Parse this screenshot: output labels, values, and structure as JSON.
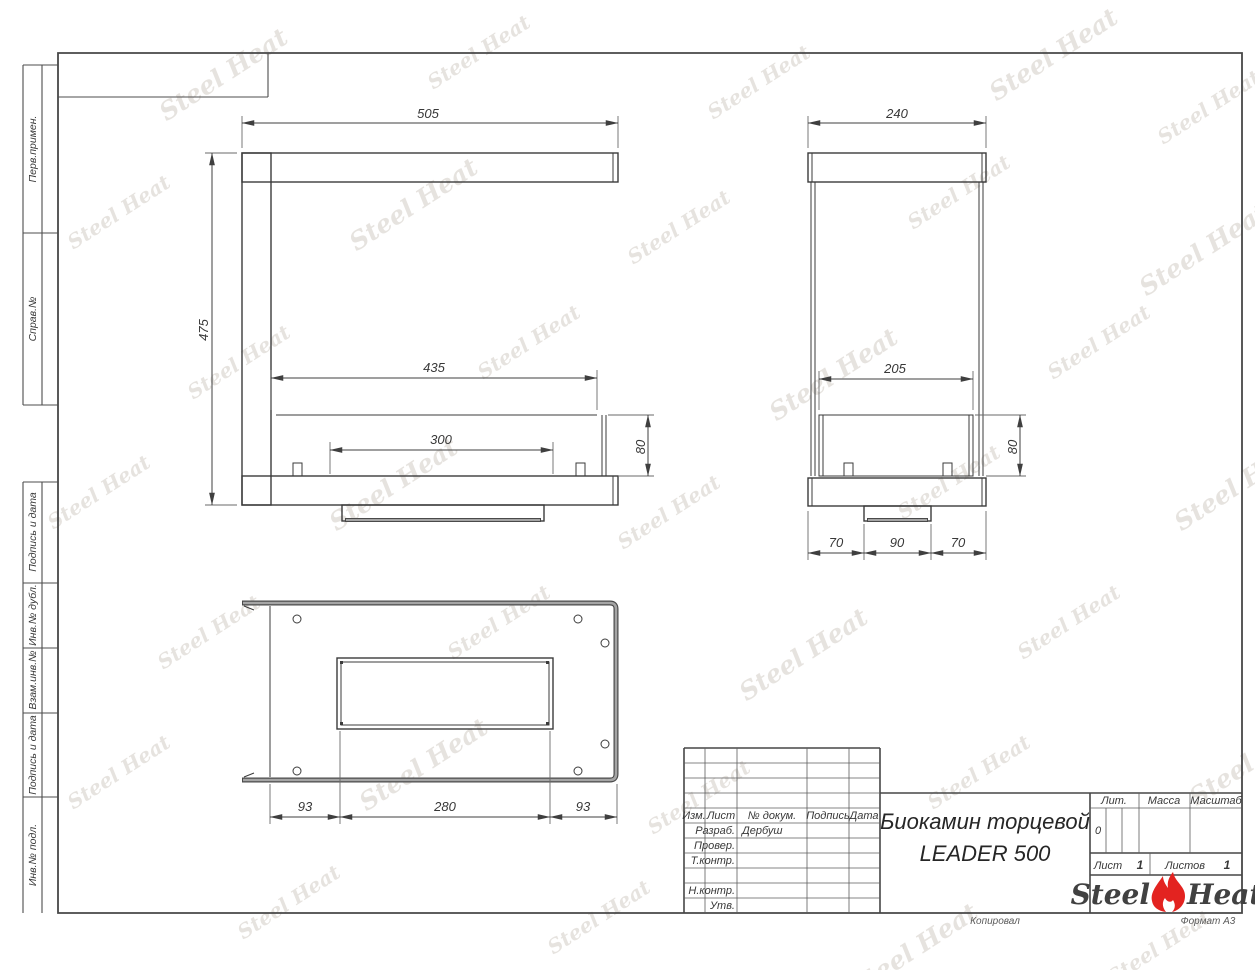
{
  "sheet": {
    "copied_note": "Копировал",
    "format_note": "Формат А3"
  },
  "margin_labels": [
    "Перв.примен.",
    "Справ.№",
    "Подпись и дата",
    "Инв.№ дубл.",
    "Взам.инв.№",
    "Подпись и дата",
    "Инв.№ подл."
  ],
  "views": {
    "front": {
      "width": "505",
      "height": "475",
      "opening_width": "435",
      "burner_width": "300",
      "box_height": "80"
    },
    "side": {
      "width": "240",
      "opening_width": "205",
      "box_height": "80",
      "bottom_left": "70",
      "bottom_center": "90",
      "bottom_right": "70"
    },
    "top": {
      "left": "93",
      "center": "280",
      "right": "93"
    }
  },
  "title_block": {
    "revision_columns": [
      "Изм.",
      "Лист",
      "№ докум.",
      "Подпись",
      "Дата"
    ],
    "developed_label": "Разраб.",
    "developed_value": "Дербуш",
    "checked_label": "Провер.",
    "tech_control_label": "Т.контр.",
    "norm_control_label": "Н.контр.",
    "approved_label": "Утв.",
    "title_line1": "Биокамин торцевой",
    "title_line2": "LEADER 500",
    "lit_label": "Лит.",
    "lit_value": "0",
    "mass_label": "Масса",
    "scale_label": "Масштаб",
    "sheet_label": "Лист",
    "sheet_number": "1",
    "sheets_label": "Листов",
    "sheets_total": "1",
    "logo_steel": "Steel",
    "logo_heat": "Heat"
  },
  "watermark": {
    "text": "Steel Heat"
  },
  "colors": {
    "flame_red": "#e32320",
    "line": "#3b3b3b"
  }
}
